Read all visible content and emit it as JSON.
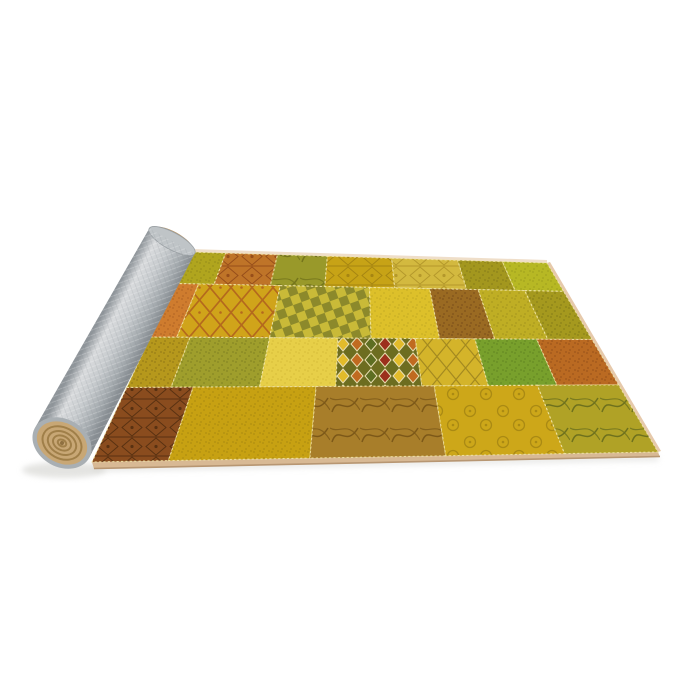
{
  "scene": {
    "alt": "Product photo of a yellow-gold patchwork area rug, partially rolled up on the left showing a gray felt backing, on a white background",
    "width": 700,
    "height": 700,
    "background": "#ffffff"
  },
  "rug": {
    "corners": {
      "tl": [
        190,
        252
      ],
      "tr": [
        547,
        263
      ],
      "br": [
        658,
        452
      ],
      "bl": [
        92,
        462
      ]
    },
    "row_v": [
      0,
      0.15,
      0.405,
      0.645,
      1
    ],
    "seam": {
      "color": "#f2e6a8",
      "width": 1.1,
      "dash": "2.2 2.2",
      "opacity": 0.85
    },
    "binding": {
      "top": "#eedcc6",
      "right": "#e6c9ab",
      "bottom": "#d8b994",
      "bottom_edge": "#b79672"
    },
    "patches": [
      {
        "row": 0,
        "u0": 0.0,
        "u1": 0.1,
        "base": "#b0a51e",
        "pattern": "speckle",
        "pc": "#4a4410",
        "pop": 0.22
      },
      {
        "row": 0,
        "u0": 0.1,
        "u1": 0.245,
        "base": "#bf7428",
        "pattern": "ornate",
        "pc": "#7c3410",
        "pop": 0.6
      },
      {
        "row": 0,
        "u0": 0.245,
        "u1": 0.385,
        "base": "#99992a",
        "pattern": "swirl",
        "pc": "#55560f",
        "pop": 0.55
      },
      {
        "row": 0,
        "u0": 0.385,
        "u1": 0.565,
        "base": "#c7a316",
        "pattern": "ornate",
        "pc": "#8a6d0e",
        "pop": 0.55
      },
      {
        "row": 0,
        "u0": 0.565,
        "u1": 0.75,
        "base": "#d3b93f",
        "pattern": "ornate",
        "pc": "#9a7d1a",
        "pop": 0.55
      },
      {
        "row": 0,
        "u0": 0.75,
        "u1": 0.875,
        "base": "#a3971e",
        "pattern": "speckle",
        "pc": "#3f3a0c",
        "pop": 0.24
      },
      {
        "row": 0,
        "u0": 0.875,
        "u1": 1.0,
        "base": "#b7b824",
        "pattern": "speckle",
        "pc": "#6d7012",
        "pop": 0.28
      },
      {
        "row": 1,
        "u0": 0.0,
        "u1": 0.06,
        "base": "#cf7c2e",
        "pattern": "speckle",
        "pc": "#7c3c14",
        "pop": 0.32
      },
      {
        "row": 1,
        "u0": 0.06,
        "u1": 0.27,
        "base": "#d0a41a",
        "pattern": "trellis",
        "pc": "#ad5a1e",
        "pop": 0.8
      },
      {
        "row": 1,
        "u0": 0.27,
        "u1": 0.5,
        "base": "#c9ba38",
        "pattern": "checker",
        "pc": "#5a6120",
        "pop": 0.55
      },
      {
        "row": 1,
        "u0": 0.5,
        "u1": 0.655,
        "base": "#ddc02a",
        "pattern": "speckle",
        "pc": "#8a7a14",
        "pop": 0.26
      },
      {
        "row": 1,
        "u0": 0.655,
        "u1": 0.78,
        "base": "#9a6a22",
        "pattern": "speckle",
        "pc": "#53300e",
        "pop": 0.4
      },
      {
        "row": 1,
        "u0": 0.78,
        "u1": 0.9,
        "base": "#bfae24",
        "pattern": "speckle",
        "pc": "#6b600f",
        "pop": 0.26
      },
      {
        "row": 1,
        "u0": 0.9,
        "u1": 1.0,
        "base": "#a5991e",
        "pattern": "speckle",
        "pc": "#4c470e",
        "pop": 0.3
      },
      {
        "row": 2,
        "u0": 0.0,
        "u1": 0.09,
        "base": "#b6981c",
        "pattern": "speckle",
        "pc": "#57430c",
        "pop": 0.32
      },
      {
        "row": 2,
        "u0": 0.09,
        "u1": 0.27,
        "base": "#9f9e2c",
        "pattern": "speckle",
        "pc": "#4e520f",
        "pop": 0.32
      },
      {
        "row": 2,
        "u0": 0.27,
        "u1": 0.425,
        "base": "#e7cf48",
        "pattern": "speckle",
        "pc": "#b89b20",
        "pop": 0.3
      },
      {
        "row": 2,
        "u0": 0.425,
        "u1": 0.6,
        "base": "#6d6d20",
        "pattern": "diamonds",
        "pcolors": [
          "#e2bb2a",
          "#c06a20",
          "#5d6e22",
          "#9c2f1c"
        ],
        "outline": "#e9deb2",
        "pop": 1
      },
      {
        "row": 2,
        "u0": 0.6,
        "u1": 0.735,
        "base": "#d4b42a",
        "pattern": "ogee",
        "pc": "#8a731a",
        "pop": 0.65
      },
      {
        "row": 2,
        "u0": 0.735,
        "u1": 0.875,
        "base": "#78a02c",
        "pattern": "speckle",
        "pc": "#3d5c12",
        "pop": 0.32
      },
      {
        "row": 2,
        "u0": 0.875,
        "u1": 1.0,
        "base": "#ba6a22",
        "pattern": "speckle",
        "pc": "#6e3510",
        "pop": 0.38
      },
      {
        "row": 3,
        "u0": 0.0,
        "u1": 0.135,
        "base": "#8a4c1e",
        "pattern": "ornate",
        "pc": "#3e220a",
        "pop": 0.65
      },
      {
        "row": 3,
        "u0": 0.135,
        "u1": 0.385,
        "base": "#c7a112",
        "pattern": "speckle",
        "pc": "#7c640a",
        "pop": 0.32
      },
      {
        "row": 3,
        "u0": 0.385,
        "u1": 0.625,
        "base": "#a87e2a",
        "pattern": "swirl",
        "pc": "#64430f",
        "pop": 0.65
      },
      {
        "row": 3,
        "u0": 0.625,
        "u1": 0.835,
        "base": "#cda719",
        "pattern": "medallion",
        "pc": "#93770f",
        "pop": 0.6
      },
      {
        "row": 3,
        "u0": 0.835,
        "u1": 1.0,
        "base": "#b0a226",
        "pattern": "swirl",
        "pc": "#4a5618",
        "pop": 0.65
      }
    ]
  },
  "roll": {
    "tip": [
      172,
      241
    ],
    "base": [
      62,
      443
    ],
    "half_width_tip": 26,
    "half_width_base": 31,
    "gradient": [
      [
        "0",
        "#8f959a"
      ],
      [
        "0.22",
        "#d9dbdd"
      ],
      [
        "0.5",
        "#c6cacd"
      ],
      [
        "0.8",
        "#a4aaae"
      ],
      [
        "1",
        "#878d92"
      ]
    ],
    "felt_light": "#ffffff",
    "felt_dark": "#848b90",
    "felt_opacity": 0.5,
    "tip_cap": "#bfc4c7",
    "tip_cap_rim": "#9aa0a4",
    "tip_edge": "#b99668"
  },
  "spiral": {
    "rim": "#a9afb3",
    "face": "#c8a775",
    "ring": "#96753f",
    "center": "#8f7040",
    "rx": 31,
    "ry": 24,
    "rings": [
      [
        20.5,
        15.5
      ],
      [
        15,
        11
      ],
      [
        9.5,
        7
      ],
      [
        4.5,
        3.2
      ]
    ]
  },
  "shadows": {
    "color": "#d6d6d2",
    "rug_opacity": 0.5,
    "roll_opacity": 0.65
  }
}
